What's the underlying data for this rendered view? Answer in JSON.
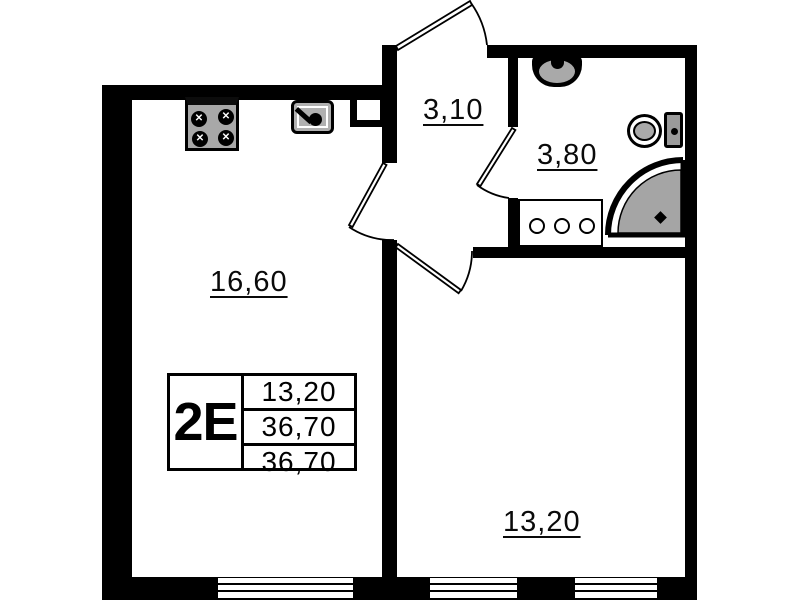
{
  "unit_card": {
    "type_label": "2Е",
    "area_rows": [
      "13,20",
      "36,70",
      "36,70"
    ]
  },
  "rooms": {
    "living_kitchen": {
      "area": "16,60"
    },
    "hallway": {
      "area": "3,10"
    },
    "bathroom": {
      "area": "3,80"
    },
    "bedroom": {
      "area": "13,20"
    }
  },
  "fixtures": {
    "stove_icon": "four-burner-stove",
    "kitchen_sink_icon": "kitchen-sink",
    "bathroom_sink_icon": "wash-basin",
    "toilet_icon": "toilet",
    "shower_icon": "corner-shower",
    "washer_icon": "washing-machine"
  },
  "colors": {
    "wall": "#000000",
    "fixture_gray": "#a8a8a8",
    "background": "#ffffff"
  }
}
